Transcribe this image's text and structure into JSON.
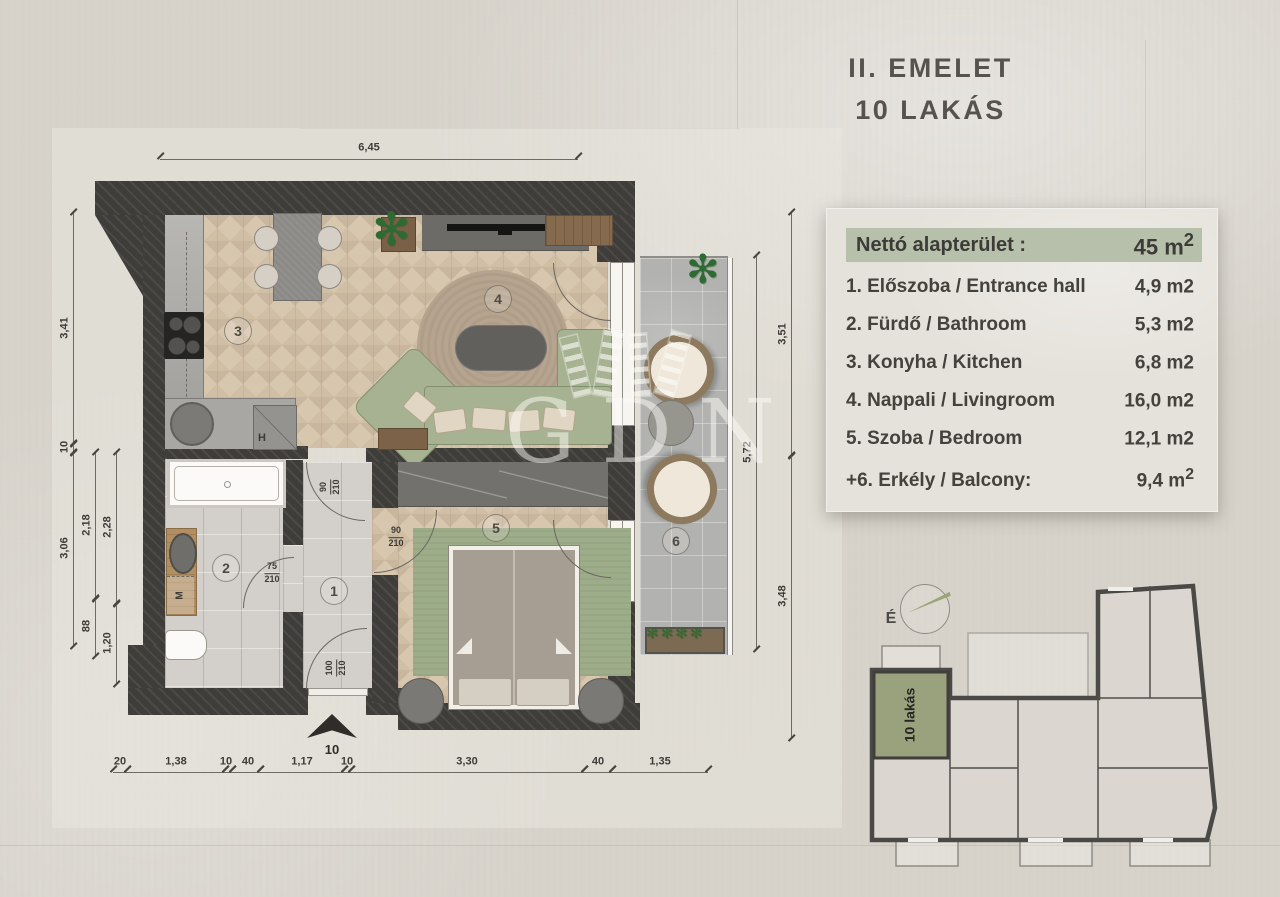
{
  "title": {
    "line1": "II. EMELET",
    "line2": "10 LAKÁS"
  },
  "legend": {
    "header": {
      "label": "Nettó alapterület :",
      "value": "45 m",
      "sup": "2"
    },
    "rows": [
      {
        "label": "1. Előszoba / Entrance hall",
        "value": "4,9 m2"
      },
      {
        "label": "2. Fürdő / Bathroom",
        "value": "5,3 m2"
      },
      {
        "label": "3. Konyha / Kitchen",
        "value": "6,8 m2"
      },
      {
        "label": "4. Nappali / Livingroom",
        "value": "16,0 m2"
      },
      {
        "label": "5. Szoba / Bedroom",
        "value": "12,1 m2"
      },
      {
        "label": "+6. Erkély / Balcony:",
        "value": "9,4 m",
        "sup": "2"
      }
    ]
  },
  "plan": {
    "rooms": [
      "1",
      "2",
      "3",
      "4",
      "5",
      "6"
    ],
    "labels": {
      "fridge": "H",
      "washer": "M",
      "entrance": "10"
    },
    "doors": {
      "hall": {
        "w": "90",
        "h": "210"
      },
      "bath": {
        "w": "75",
        "h": "210"
      },
      "bedroom": {
        "w": "90",
        "h": "210"
      },
      "entry": {
        "w": "100",
        "h": "210"
      }
    },
    "dims": {
      "top": "6,45",
      "left": [
        "3,41",
        "10",
        "3,06",
        "2,18",
        "88",
        "2,28",
        "1,20"
      ],
      "right": [
        "3,51",
        "5,72",
        "3,48"
      ],
      "bottom": [
        "20",
        "1,38",
        "10",
        "40",
        "1,17",
        "10",
        "3,30",
        "40",
        "1,35"
      ]
    }
  },
  "keyplan": {
    "north": "É",
    "unit": "10 lakás"
  },
  "watermark": {
    "text": "GDN"
  },
  "colors": {
    "accent_green": "#b6c0aa",
    "unit_green": "#99a27d",
    "wall_dark": "#3e3d3a",
    "sofa_green": "#a6b291",
    "wood_floor": "#d8c7af",
    "balcony_gray": "#b2b3b0"
  }
}
